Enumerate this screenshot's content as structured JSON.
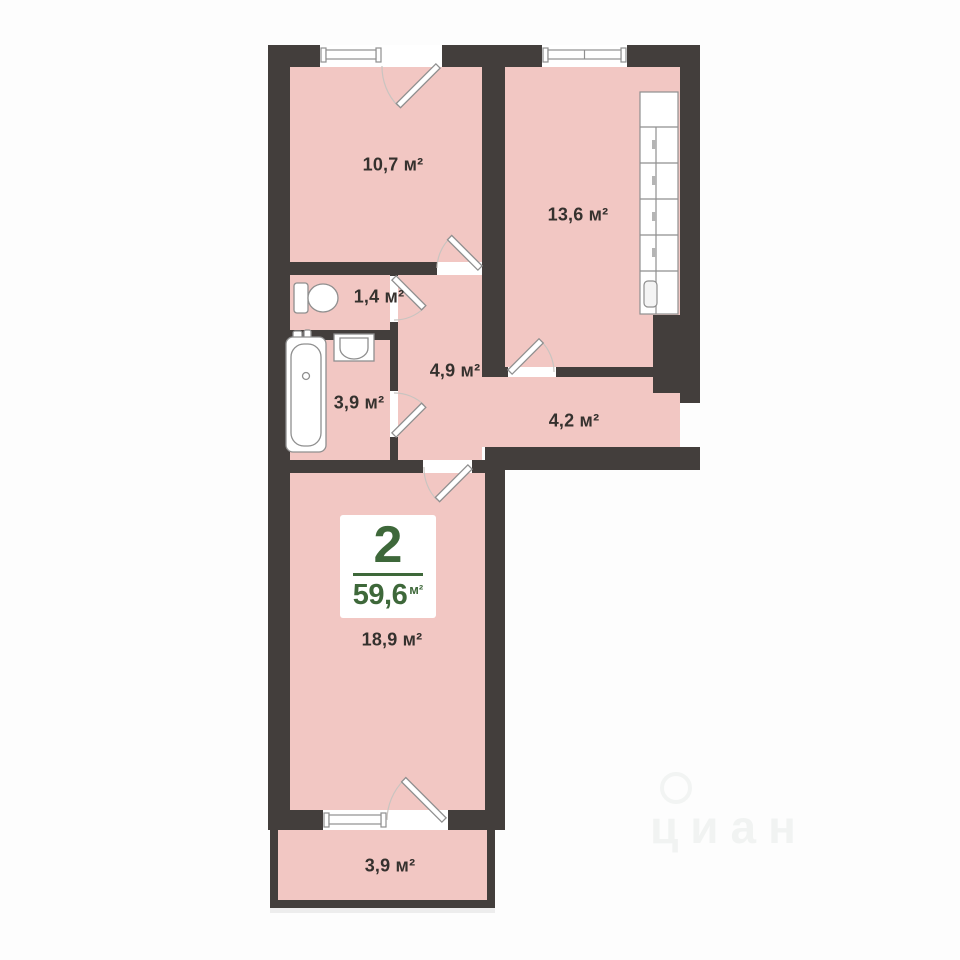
{
  "badge": {
    "rooms_count": "2",
    "total_area": "59,6",
    "unit": "м²"
  },
  "rooms": {
    "room1": {
      "label": "10,7 м²"
    },
    "kitchen": {
      "label": "13,6 м²"
    },
    "wc": {
      "label": "1,4 м²"
    },
    "hall": {
      "label": "4,9 м²"
    },
    "bathroom": {
      "label": "3,9 м²"
    },
    "entry": {
      "label": "4,2 м²"
    },
    "room2": {
      "label": "18,9 м²"
    },
    "balcony": {
      "label": "3,9 м²"
    }
  },
  "watermark": {
    "text": "циан"
  },
  "colors": {
    "wall": "#433e3c",
    "fill": "#f2c7c3",
    "green": "#3e683a",
    "line": "#8f8f8f",
    "bg": "#fdfdfd",
    "label": "#35312e"
  }
}
